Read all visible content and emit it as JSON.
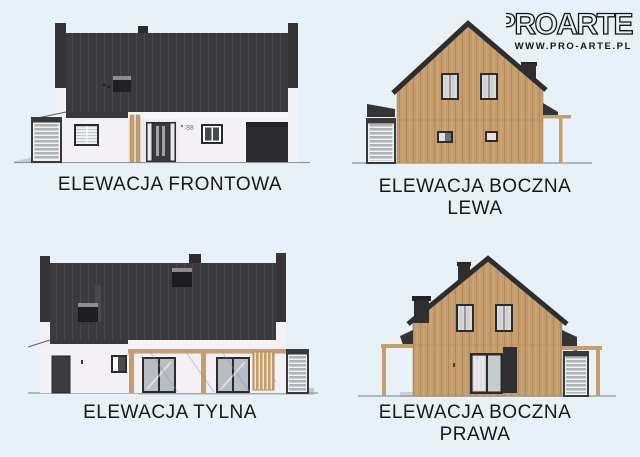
{
  "page": {
    "background": "#e8f1f8"
  },
  "logo": {
    "brand": "PROARTE",
    "url": "WWW.PRO-ARTE.PL"
  },
  "elevations": {
    "front": {
      "caption": "ELEWACJA FRONTOWA",
      "house_number": "88"
    },
    "side_left": {
      "caption": "ELEWACJA BOCZNA",
      "caption_line2": "LEWA"
    },
    "rear": {
      "caption": "ELEWACJA TYLNA"
    },
    "side_right": {
      "caption": "ELEWACJA BOCZNA",
      "caption_line2": "PRAWA"
    }
  },
  "palette": {
    "roof": "#3b3b3d",
    "wood_cladding": "#c59c6d",
    "wall": "#f3f1f5",
    "window_frame": "#2b2b2d",
    "pergola_wood": "#c79e6b",
    "ground_line": "#8f969c",
    "background": "#e8f1f8"
  }
}
